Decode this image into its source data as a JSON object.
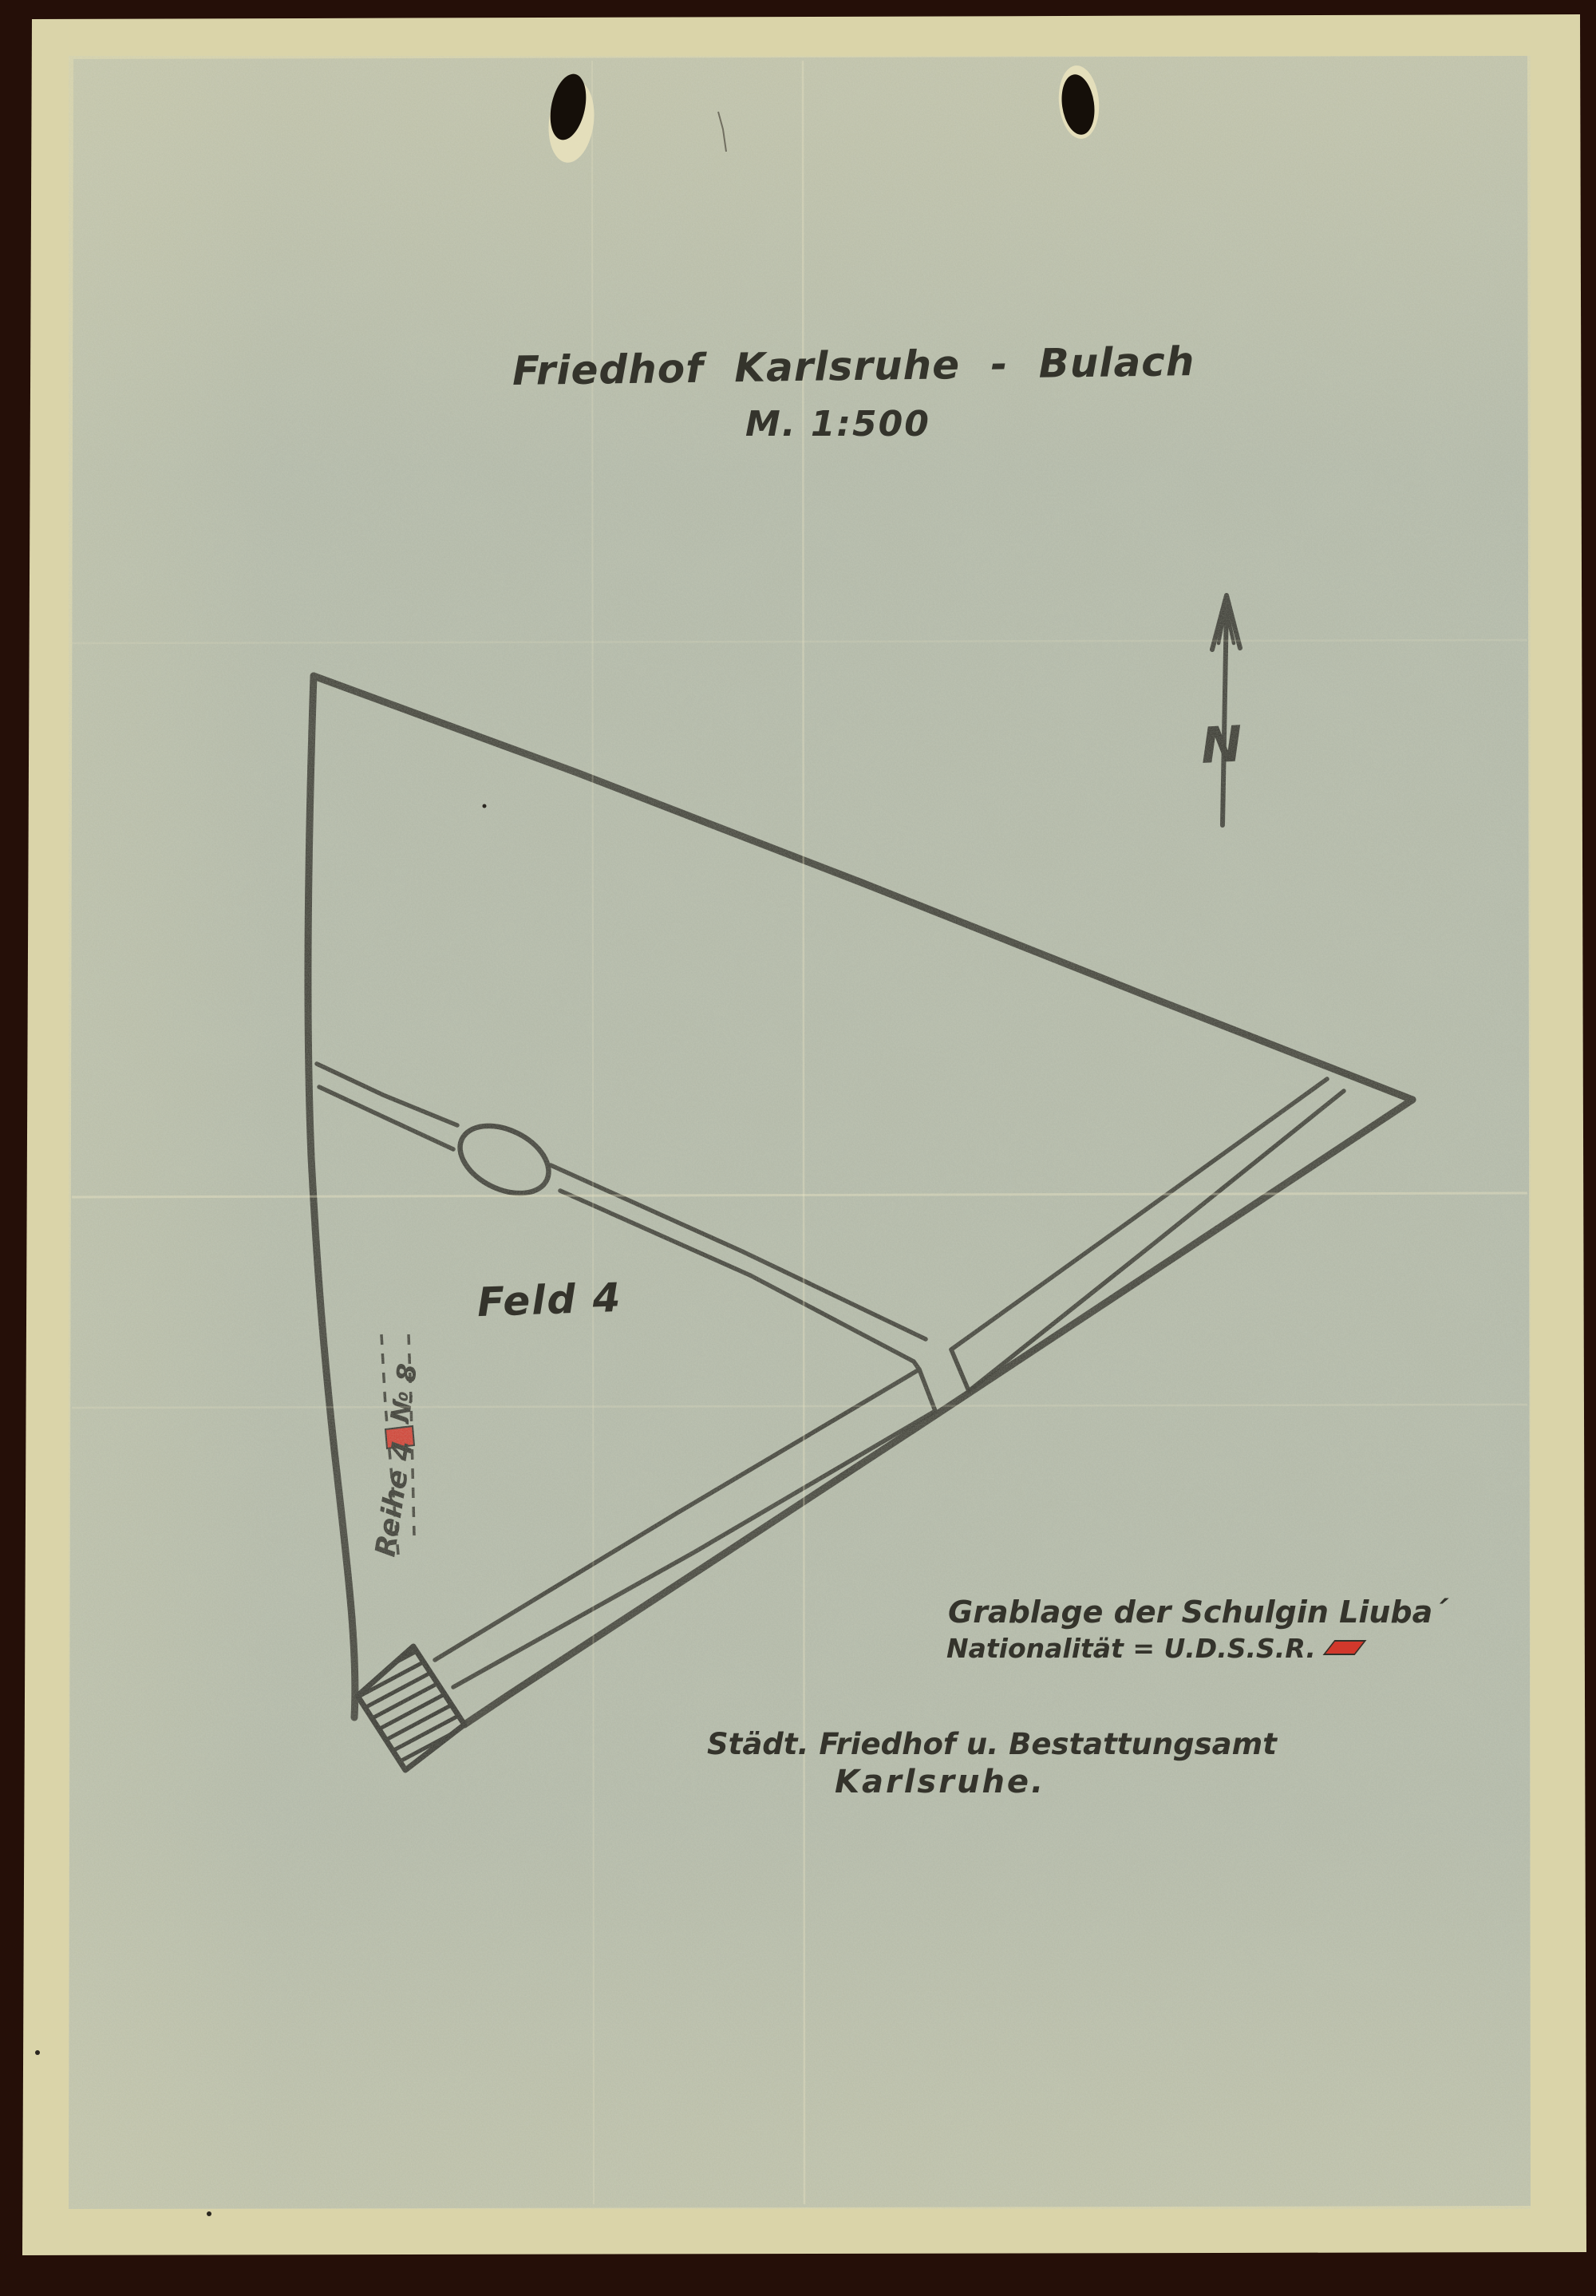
{
  "page": {
    "title": "Friedhof Karlsruhe - Bulach",
    "scale": "M. 1:500"
  },
  "map": {
    "field_label": "Feld 4",
    "north_label": "N",
    "grave_row_label": "Reihe 4",
    "grave_number_label": "№ 8"
  },
  "annotations": {
    "grave_note_line1": "Grablage der Schulgin Liuba´",
    "grave_note_line2": "Nationalität = U.D.S.S.R."
  },
  "footer": {
    "line1": "Städt. Friedhof u. Bestattungsamt",
    "line2": "Karlsruhe."
  },
  "colors": {
    "scan_background": "#250f08",
    "paper_border": "#dad4a9",
    "paper_inner": "#b2b8a7",
    "ink": "#23221c",
    "grave_marker_red": "#d42a1e"
  }
}
